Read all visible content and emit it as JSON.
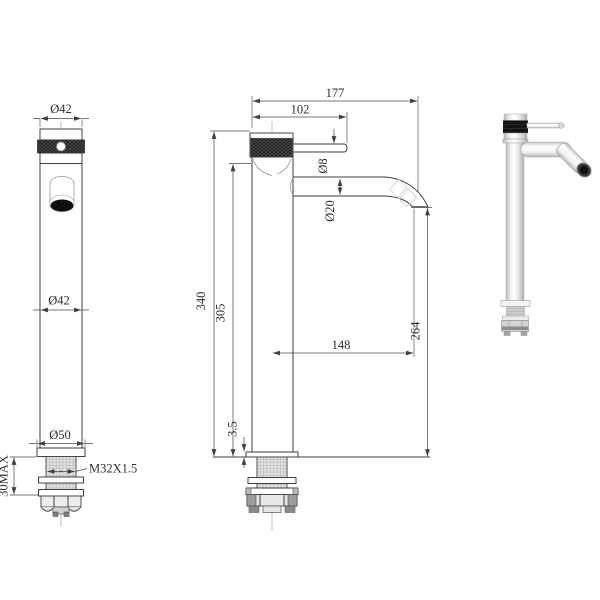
{
  "drawing": {
    "kind": "faucet-technical-drawing",
    "line_color": "#3f3f3f",
    "knurl_color": "#1c1c1c",
    "chrome_highlight": "#ffffff",
    "chrome_shadow": "#aaadaf",
    "views": {
      "front": {
        "top_diameter": "Ø42",
        "body_diameter": "Ø42",
        "base_diameter": "Ø50",
        "thread_spec": "M32X1.5",
        "max_mount_thickness": "30MAX"
      },
      "side": {
        "overall_reach": "177",
        "lever_reach": "102",
        "lever_diameter": "Ø8",
        "spout_diameter": "Ø20",
        "overall_height": "340",
        "body_height": "305",
        "spout_projection": "148",
        "outlet_clearance": "264",
        "base_plate_thickness": "3.5"
      }
    }
  }
}
